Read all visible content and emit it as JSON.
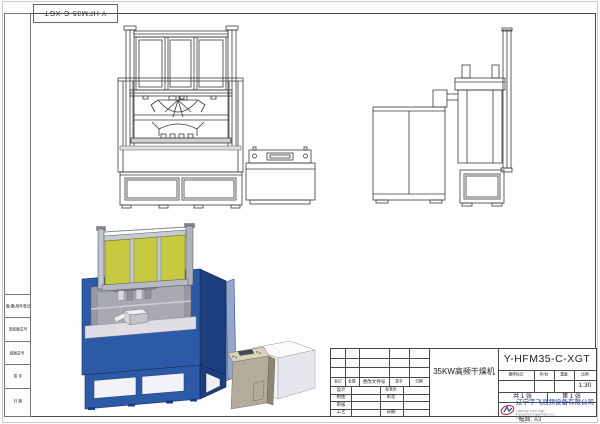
{
  "top_corner_box": {
    "drawing_number": "Y-HFM35-C-XGT"
  },
  "left_margin": {
    "cells": [
      "借(通)用件登记",
      "旧底图总号",
      "底图总号",
      "签 字",
      "日 期"
    ]
  },
  "title_block": {
    "drawing_number": "Y-HFM35-C-XGT",
    "part_name": "35KW高频干燥机",
    "revision_headers": [
      "标记",
      "处数",
      "更改文件号",
      "签字",
      "日期"
    ],
    "roles_left": [
      "设计",
      "制图",
      "审核",
      "工艺"
    ],
    "roles_right": [
      "标准化",
      "审定",
      "",
      "日期"
    ],
    "info_headers": [
      "图样标记",
      "件/台",
      "重量",
      "比例"
    ],
    "scale_value": "1:30",
    "sheet_total": "共 1 张",
    "sheet_number": "第 1 张",
    "company_name": "辽宁宇飞高频设备有限公司",
    "company_name_en": "Liaoning Yufei High Frequency Equipment Co., Ltd.",
    "paper_size": "幅面: A3"
  },
  "colors": {
    "machine_blue": "#2d5aa7",
    "machine_blue_dark": "#1d3e7d",
    "panel_yellow": "#c6ca40",
    "frame_silver": "#c2c7cf",
    "console_beige": "#d9d3bb",
    "logo_red": "#c82838",
    "logo_blue": "#1f3f9a",
    "line_color": "#3c3c3c"
  }
}
